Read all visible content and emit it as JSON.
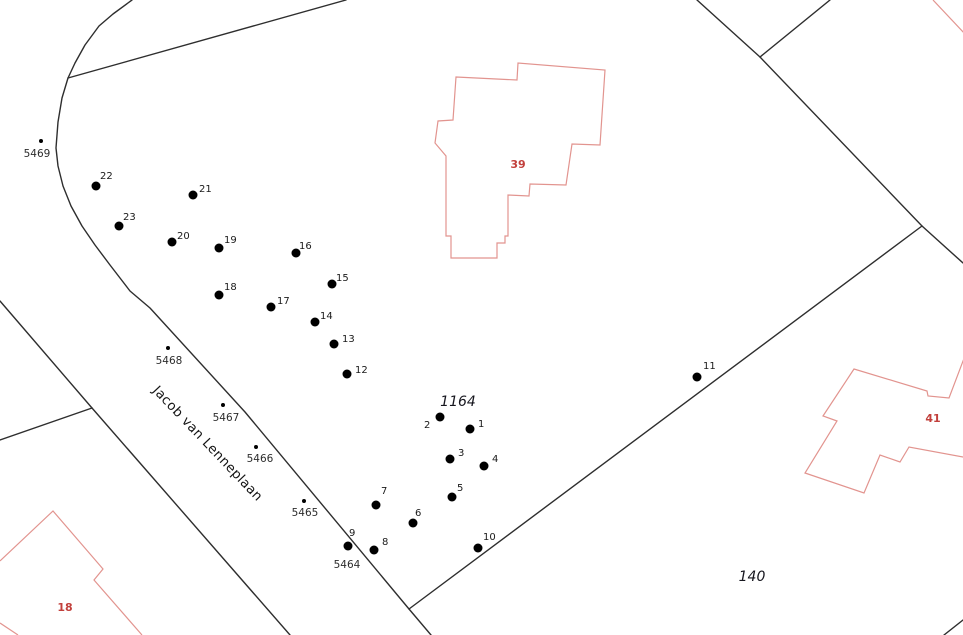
{
  "colors": {
    "background": "#ffffff",
    "boundary_line": "#2e2e2e",
    "building_outline": "#e2948f",
    "building_label": "#c2403c",
    "point_dot": "#000000",
    "label_text": "#1a1a1a"
  },
  "street": {
    "name": "Jacob van Lenneplaan"
  },
  "parcel_labels": [
    {
      "text": "1164",
      "x": 458,
      "y": 406
    },
    {
      "text": "140",
      "x": 752,
      "y": 581
    }
  ],
  "building_labels": [
    {
      "text": "39",
      "x": 518,
      "y": 168
    },
    {
      "text": "41",
      "x": 933,
      "y": 422
    },
    {
      "text": "18",
      "x": 65,
      "y": 611
    }
  ],
  "survey_points": [
    {
      "n": "1",
      "x": 470,
      "y": 429,
      "lx": 478,
      "ly": 427
    },
    {
      "n": "2",
      "x": 440,
      "y": 417,
      "lx": 424,
      "ly": 428
    },
    {
      "n": "3",
      "x": 450,
      "y": 459,
      "lx": 458,
      "ly": 456
    },
    {
      "n": "4",
      "x": 484,
      "y": 466,
      "lx": 492,
      "ly": 462
    },
    {
      "n": "5",
      "x": 452,
      "y": 497,
      "lx": 457,
      "ly": 491
    },
    {
      "n": "6",
      "x": 413,
      "y": 523,
      "lx": 415,
      "ly": 516
    },
    {
      "n": "7",
      "x": 376,
      "y": 505,
      "lx": 381,
      "ly": 494
    },
    {
      "n": "8",
      "x": 374,
      "y": 550,
      "lx": 382,
      "ly": 545
    },
    {
      "n": "9",
      "x": 348,
      "y": 546,
      "lx": 349,
      "ly": 536
    },
    {
      "n": "10",
      "x": 478,
      "y": 548,
      "lx": 483,
      "ly": 540
    },
    {
      "n": "11",
      "x": 697,
      "y": 377,
      "lx": 703,
      "ly": 369
    },
    {
      "n": "12",
      "x": 347,
      "y": 374,
      "lx": 355,
      "ly": 373
    },
    {
      "n": "13",
      "x": 334,
      "y": 344,
      "lx": 342,
      "ly": 342
    },
    {
      "n": "14",
      "x": 315,
      "y": 322,
      "lx": 320,
      "ly": 319
    },
    {
      "n": "15",
      "x": 332,
      "y": 284,
      "lx": 336,
      "ly": 281
    },
    {
      "n": "16",
      "x": 296,
      "y": 253,
      "lx": 299,
      "ly": 249
    },
    {
      "n": "17",
      "x": 271,
      "y": 307,
      "lx": 277,
      "ly": 304
    },
    {
      "n": "18",
      "x": 219,
      "y": 295,
      "lx": 224,
      "ly": 290
    },
    {
      "n": "19",
      "x": 219,
      "y": 248,
      "lx": 224,
      "ly": 243
    },
    {
      "n": "20",
      "x": 172,
      "y": 242,
      "lx": 177,
      "ly": 239
    },
    {
      "n": "21",
      "x": 193,
      "y": 195,
      "lx": 199,
      "ly": 192
    },
    {
      "n": "22",
      "x": 96,
      "y": 186,
      "lx": 100,
      "ly": 179
    },
    {
      "n": "23",
      "x": 119,
      "y": 226,
      "lx": 123,
      "ly": 220
    }
  ],
  "benchmarks": [
    {
      "id": "5469",
      "x": 41,
      "y": 141,
      "lx": 37,
      "ly": 157
    },
    {
      "id": "5468",
      "x": 168,
      "y": 348,
      "lx": 169,
      "ly": 364
    },
    {
      "id": "5467",
      "x": 223,
      "y": 405,
      "lx": 226,
      "ly": 421
    },
    {
      "id": "5466",
      "x": 256,
      "y": 447,
      "lx": 260,
      "ly": 462
    },
    {
      "id": "5465",
      "x": 304,
      "y": 501,
      "lx": 305,
      "ly": 516
    },
    {
      "id": "5464",
      "x": 348,
      "y": 546,
      "lx": 347,
      "ly": 568
    }
  ]
}
